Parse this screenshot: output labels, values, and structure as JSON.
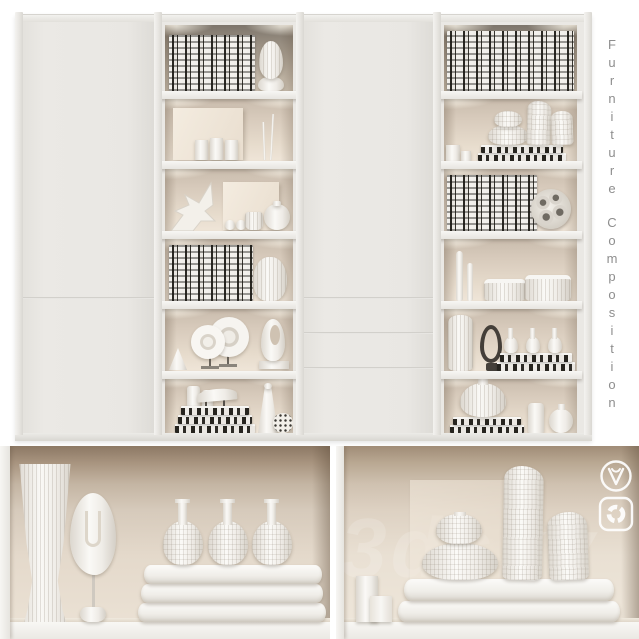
{
  "page": {
    "background_color": "#ffffff"
  },
  "side_title": {
    "text": "Furniture Composition"
  },
  "watermark": {
    "text": "3dsky"
  },
  "icons": {
    "renderer_badges": [
      "vray-logo",
      "corona-renderer-logo"
    ]
  },
  "palette": {
    "cabinet_white": "#e9e7e3",
    "shelf_back_beige": "#d7cabb",
    "top_shelf_shadow": "#7d756b",
    "niche_wall": "#d6cabb",
    "niche_ceiling": "#8c7864",
    "book_spine_dark": "#26241f",
    "object_white": "#f6f4f1",
    "title_gray": "#8e8e8e"
  },
  "scene": {
    "main_view": {
      "subject": "white storage cabinet with two open shelf columns, two plain doors and three drawers",
      "left_column_shelves": [
        "row of striped books with egg-shaped vase",
        "leaning canvas, three small boxes, two twig bud vases",
        "branch sculpture, canvas, mini bottles, ribbed cup, sphere vase",
        "row of striped books with ribbed barrel vase",
        "faceted block, two disc sculptures on stands, pierced loop sculpture",
        "stack of striped books with horn sculpture, canisters, cone bottle, patterned sphere"
      ],
      "right_column_shelves": [
        "full row of striped books",
        "small boxes, pebble-stack vase on striped books, two shard vases",
        "row of striped books with cratered sphere",
        "two spire bud vases, two ribbed lidded boxes",
        "ribbed vase, dark wire loop sculpture, three bottles on striped books",
        "gourd vase on striped books, cylinder vase, bud vase"
      ]
    },
    "detail_views": [
      "niche with corset floor vase, abstract face sculpture on stand, three gourd bottles on folded towels",
      "niche with boxes, pebble-stack vase and two shard vases on folded towels"
    ]
  }
}
